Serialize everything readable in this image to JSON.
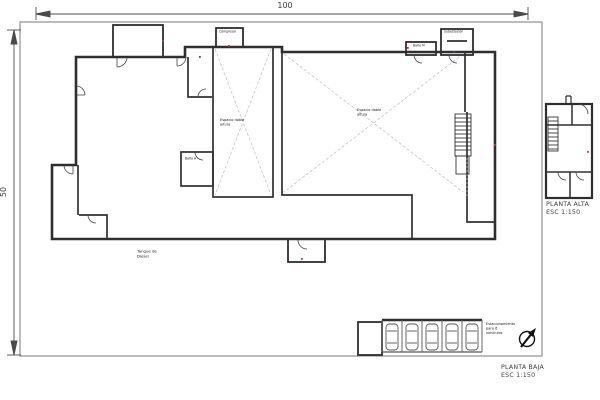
{
  "sheet": {
    "dim_width": "100",
    "dim_height": "50"
  },
  "planta_baja": {
    "title": "PLANTA BAJA",
    "scale": "ESC 1:150",
    "labels": {
      "compresor": "Compresor",
      "subestacion": "Subestación",
      "bano_m": "Baño M",
      "bano_h": "Baño H",
      "espacio_doble_izq": "Espacio doble\naltura",
      "espacio_doble_der": "Espacio doble\naltura",
      "tanque_diesel": "Tanque de\nDiesel",
      "estacionamiento": "Estacionamiento\npara 6\nvehículos"
    }
  },
  "planta_alta": {
    "title": "PLANTA ALTA",
    "scale": "ESC 1:150"
  },
  "icons": {
    "north_arrow": "north-arrow",
    "car": "car-symbol",
    "stairs": "stairs-symbol"
  },
  "colors": {
    "wall": "#2e2e2e",
    "frame": "#8f8f8f",
    "dimension": "#4a4a4a",
    "hatch_cross": "#c4c4c4",
    "label": "#15151f"
  }
}
